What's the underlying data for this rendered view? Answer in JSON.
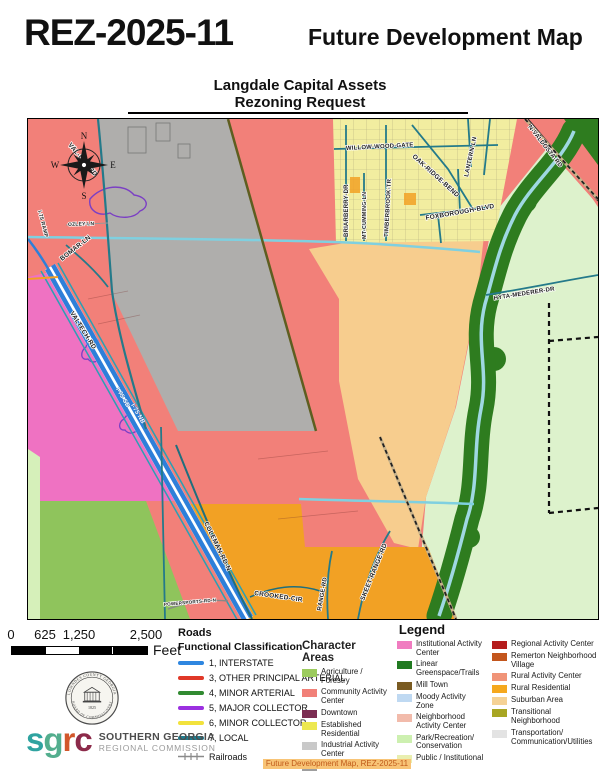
{
  "header": {
    "case_number": "REZ-2025-11",
    "title": "Future Development Map",
    "subtitle1": "Langdale Capital Assets",
    "subtitle2": "Rezoning Request"
  },
  "map": {
    "compass": {
      "north": "N",
      "east": "E",
      "south": "S",
      "west": "W"
    },
    "road_labels": [
      {
        "text": "I-75 RAMP",
        "x": 10,
        "y": 92,
        "r": 75,
        "s": 5.2
      },
      {
        "text": "VAL-DEL-RD",
        "x": 40,
        "y": 26,
        "r": 50,
        "s": 6.5
      },
      {
        "text": "OZLEY-LN",
        "x": 40,
        "y": 107,
        "r": -2,
        "s": 5
      },
      {
        "text": "BOMAR-LN",
        "x": 34,
        "y": 142,
        "r": -38,
        "s": 6.5
      },
      {
        "text": "VALTECH-RD",
        "x": 42,
        "y": 194,
        "r": 58,
        "s": 6.5
      },
      {
        "text": "I-75 SB",
        "x": 88,
        "y": 270,
        "r": 60,
        "s": 6,
        "cls": "on-road"
      },
      {
        "text": "I-75 NB",
        "x": 103,
        "y": 286,
        "r": 60,
        "s": 6,
        "cls": "on-road"
      },
      {
        "text": "COLEMAN-RD-N",
        "x": 176,
        "y": 404,
        "r": 64,
        "s": 6.5
      },
      {
        "text": "CROOKED-CIR",
        "x": 226,
        "y": 476,
        "r": 8,
        "s": 6.5
      },
      {
        "text": "POWERSPORTS-RD-N",
        "x": 136,
        "y": 487,
        "r": -5,
        "s": 4.6
      },
      {
        "text": "RANGE-RD",
        "x": 293,
        "y": 492,
        "r": -80,
        "s": 6
      },
      {
        "text": "SKEET-RANGE-RD",
        "x": 336,
        "y": 482,
        "r": -68,
        "s": 6.5
      },
      {
        "text": "WILLOW-WOOD-GATE",
        "x": 318,
        "y": 31,
        "r": -3,
        "s": 6
      },
      {
        "text": "BRIARBERRY-DR",
        "x": 320,
        "y": 118,
        "r": -90,
        "s": 6
      },
      {
        "text": "MT-CUMMING-LN",
        "x": 338,
        "y": 120,
        "r": -90,
        "s": 5.4
      },
      {
        "text": "TIMBERBROOK-TR",
        "x": 360,
        "y": 118,
        "r": -87,
        "s": 6
      },
      {
        "text": "OAK-RIDGE-BEND",
        "x": 384,
        "y": 38,
        "r": 42,
        "s": 6.5
      },
      {
        "text": "FOXBOROUGH-BLVD",
        "x": 398,
        "y": 101,
        "r": -10,
        "s": 6.5
      },
      {
        "text": "LANTERN-LN",
        "x": 440,
        "y": 58,
        "r": -78,
        "s": 6
      },
      {
        "text": "N-VALDOSTA-RD",
        "x": 500,
        "y": 8,
        "r": 52,
        "s": 6
      },
      {
        "text": "HYTA-MEDERER-DR",
        "x": 466,
        "y": 181,
        "r": -9,
        "s": 6
      }
    ]
  },
  "scale_bar": {
    "ticks": [
      "0",
      "625",
      "1,250",
      "2,500"
    ],
    "unit": "Feet"
  },
  "roads_legend": {
    "title": "Roads",
    "subtitle": "Functional Classification",
    "items": [
      {
        "label": "1, INTERSTATE",
        "color": "#2E86E0"
      },
      {
        "label": "3, OTHER PRINCIPAL ARTERIAL",
        "color": "#E03828"
      },
      {
        "label": "4, MINOR ARTERIAL",
        "color": "#318A31"
      },
      {
        "label": "5, MAJOR COLLECTOR",
        "color": "#9B30E0"
      },
      {
        "label": "6, MINOR COLLECTOR",
        "color": "#F2E23C"
      },
      {
        "label": "7, LOCAL",
        "color": "#1F7A8C"
      },
      {
        "label": "Railroads",
        "color": "#8A8A8A",
        "railroad": true
      }
    ]
  },
  "character_legend": {
    "title": "Legend",
    "section": "Character Areas",
    "columns": [
      [
        {
          "label": "Agriculture / Forestry",
          "color": "#9CCB5E"
        },
        {
          "label": "Community Activity Center",
          "color": "#F18078"
        },
        {
          "label": "Downtown",
          "color": "#7B2D52"
        },
        {
          "label": "Established Residential",
          "color": "#EDE850"
        },
        {
          "label": "Industrial Activity Center",
          "color": "#C9C9C9"
        },
        {
          "label": "Industrial Area",
          "color": "#9E9E9E"
        }
      ],
      [
        {
          "label": "Institutional Activity Center",
          "color": "#F07CC0"
        },
        {
          "label": "Linear Greenspace/Trails",
          "color": "#217A21"
        },
        {
          "label": "Mill Town",
          "color": "#7A5B22"
        },
        {
          "label": "Moody Activity Zone",
          "color": "#BFD9F2"
        },
        {
          "label": "Neighborhood Activity Center",
          "color": "#F2BBAB"
        },
        {
          "label": "Park/Recreation/ Conservation",
          "color": "#CDF0B0"
        },
        {
          "label": "Public / Institutional",
          "color": "#E9EFB0"
        }
      ],
      [
        {
          "label": "Regional Activity Center",
          "color": "#B51D1D"
        },
        {
          "label": "Remerton Neighborhood Village",
          "color": "#C3561D"
        },
        {
          "label": "Rural Activity Center",
          "color": "#F09478"
        },
        {
          "label": "Rural Residential",
          "color": "#F5A81E"
        },
        {
          "label": "Suburban Area",
          "color": "#F5D295"
        },
        {
          "label": "Transitional Neighborhood",
          "color": "#A8A623"
        },
        {
          "label": "Transportation/ Communication/Utilities",
          "color": "#E3E3E3"
        }
      ]
    ]
  },
  "logos": {
    "seal_top": "LOWNDES COUNTY GEORGIA",
    "seal_bottom": "BOARD OF COMMISSIONERS",
    "seal_year": "1825",
    "sgrc_letters": [
      {
        "ch": "s",
        "color": "#2FA3A0"
      },
      {
        "ch": "g",
        "color": "#53AE8E"
      },
      {
        "ch": "r",
        "color": "#D2572B"
      },
      {
        "ch": "c",
        "color": "#8C2A4A"
      }
    ],
    "sgrc_name1": "SOUTHERN GEORGIA",
    "sgrc_name2": "REGIONAL COMMISSION"
  },
  "footer": {
    "line1": "Future Development Map, REZ-2025-11",
    "line2": "2026-03-30 –GLPC"
  },
  "colors": {
    "community": "#F28079",
    "industrial_area": "#AFAEAC",
    "established": "#F2EDA0",
    "suburban": "#F7CD8E",
    "park": "#DDF2CC",
    "park_pale": "#D6F0BA",
    "linear_greenspace": "#2E7C1F",
    "agriculture": "#8FC45C",
    "institutional": "#EF72C2",
    "rural_residential": "#F2A124",
    "river": "#9FD8E2",
    "stream": "#7FD0E0",
    "interstate": "#2E7FD9",
    "local_teal": "#247A8A",
    "olive_road": "#5E5E20",
    "purple_outline": "#7B3FC4",
    "railroad_tan": "#C8B28A"
  }
}
